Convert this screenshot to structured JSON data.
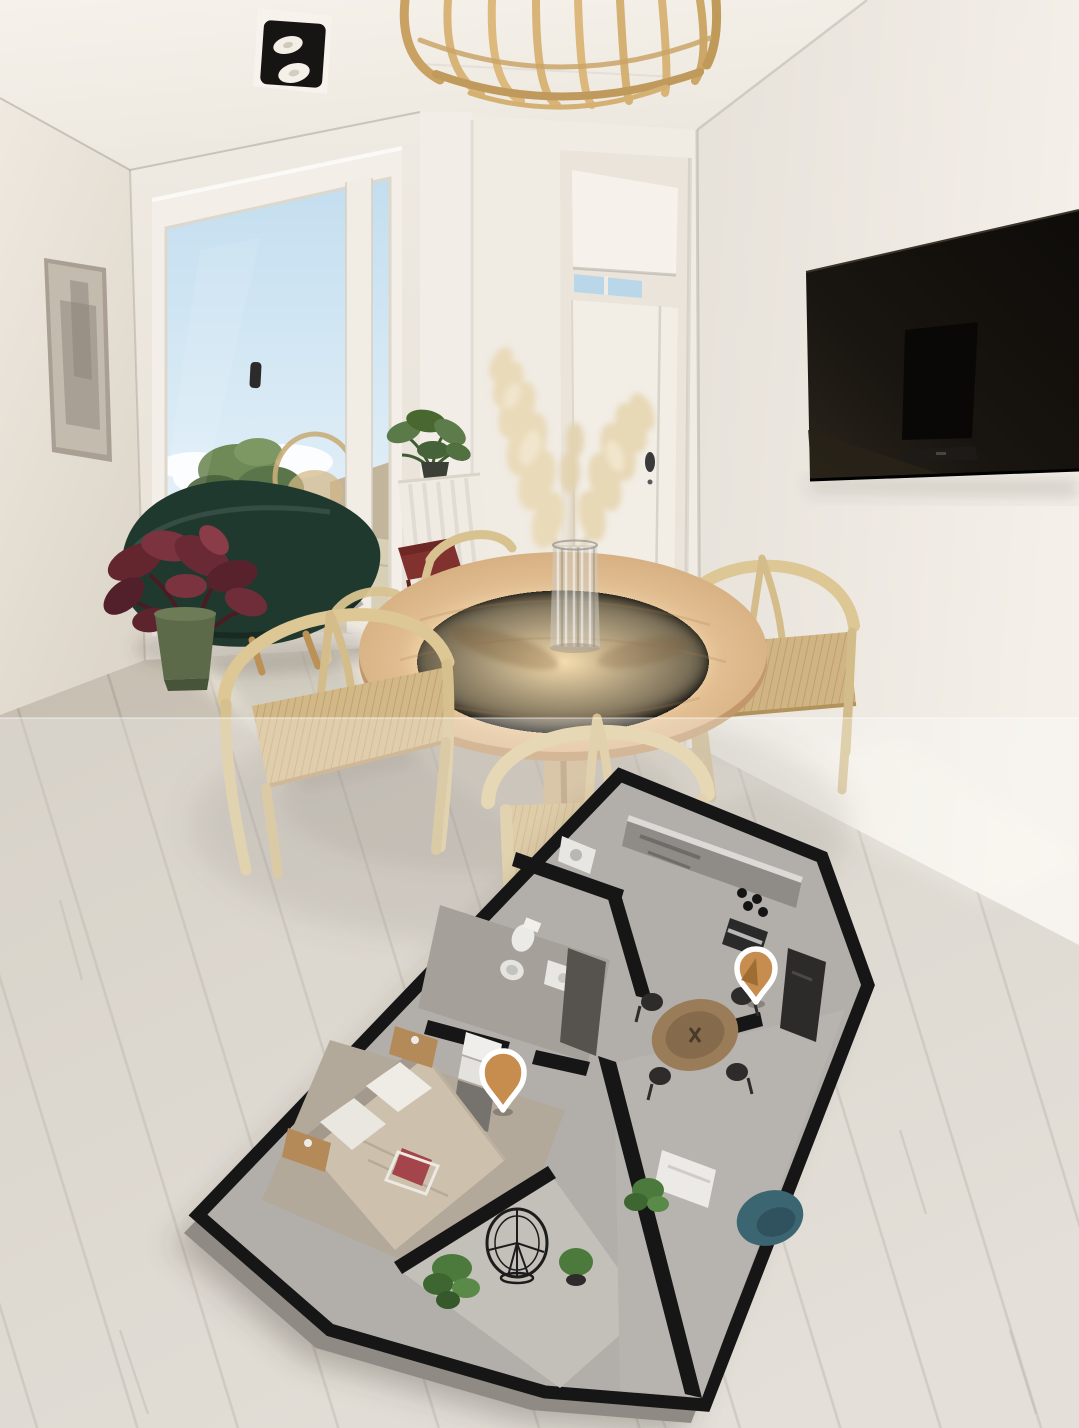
{
  "app": {
    "type": "3d-property-viewer",
    "description": "Photorealistic render of an apartment living-dining room with a semi-transparent wash over the lower half, a 3D cutaway floor-plan model overlay and two tappable location pins"
  },
  "scene": {
    "room": {
      "elements": [
        "ceiling-spotlight",
        "rattan-pendant-lamp",
        "wall-artwork",
        "sliding-glass-door",
        "balcony-view-sky",
        "balcony-view-plant",
        "balcony-rattan-chair",
        "green-lounge-chair",
        "burgundy-plant",
        "radiator-plant",
        "round-wood-dining-table",
        "glass-vase",
        "pampas-grass",
        "wishbone-chair-left",
        "wishbone-chair-right",
        "wishbone-chair-front",
        "white-interior-door",
        "hallway-nook",
        "wall-mounted-tv",
        "wood-plank-floor"
      ]
    },
    "floorplan": {
      "style": "3d-cutaway-model",
      "rooms": [
        "kitchen",
        "laundry",
        "bathroom",
        "bedroom",
        "dining-area",
        "living-area",
        "balcony"
      ],
      "furniture": [
        "kitchen-counter",
        "stove",
        "oven",
        "fridge-column",
        "toilet",
        "bidet",
        "double-bed",
        "pillows",
        "red-cushion",
        "nightstands",
        "wardrobe",
        "round-dining-table",
        "dining-chairs",
        "teal-armchair",
        "white-shelf",
        "hanging-egg-chair",
        "potted-plants"
      ],
      "pins": [
        {
          "id": "pin-bedroom",
          "x": 503,
          "y": 1078
        },
        {
          "id": "pin-dining",
          "x": 755,
          "y": 972
        }
      ]
    }
  },
  "colors": {
    "pin_fill": "#c78d4f",
    "pin_border": "#ffffff",
    "pin_facet": "#97672f",
    "ceiling": "#f3efe7",
    "left_wall": "#e8e2d9",
    "right_wall": "#efeae3",
    "floor_wood": "#cbc3b7",
    "overlay_wash": "rgba(255,255,255,0.30)",
    "tv_screen": "#16130f",
    "table_wood": "#d9b184",
    "chair_wood": "#dcc795",
    "lounge_chair": "#20392f",
    "plan_wall": "#161616",
    "plan_floor": "#b2aeaa",
    "teal_chair": "#3c6572",
    "sky": "#c9e2f1"
  }
}
